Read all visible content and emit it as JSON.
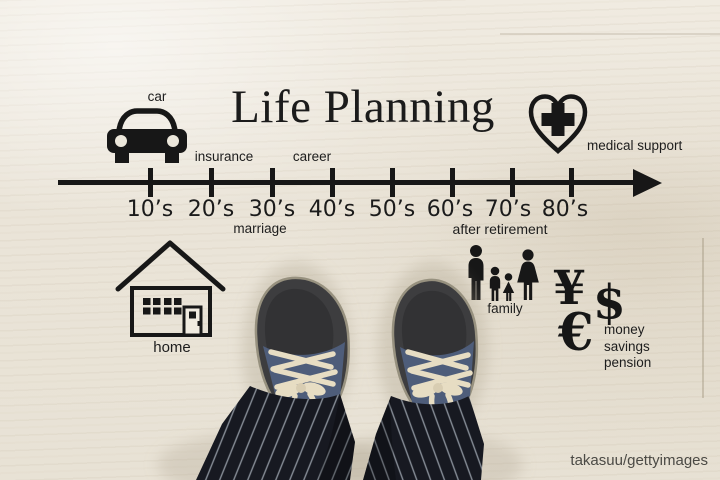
{
  "title": "Life Planning",
  "watermark": "takasuu/gettyimages",
  "timeline": {
    "decades": [
      "10’s",
      "20’s",
      "30’s",
      "40’s",
      "50’s",
      "60’s",
      "70’s",
      "80’s"
    ],
    "above_labels": [
      {
        "text": "insurance",
        "position": "above 20's"
      },
      {
        "text": "career",
        "position": "above 30's–40's"
      }
    ],
    "below_labels": [
      {
        "text": "marriage",
        "position": "below 30's"
      },
      {
        "text": "after retirement",
        "position": "below 60's–70's"
      }
    ]
  },
  "groups": {
    "car": {
      "label": "car",
      "icon": "car-icon"
    },
    "medical": {
      "label": "medical support",
      "icon": "heart-with-cross-icon"
    },
    "home": {
      "label": "home",
      "icon": "house-icon"
    },
    "family": {
      "label": "family",
      "icon": "family-silhouettes-icon"
    },
    "money": {
      "symbols": [
        "¥",
        "$",
        "€"
      ],
      "label_lines": [
        "money",
        "savings",
        "pension"
      ]
    }
  },
  "colors": {
    "ink": "#1a1a1a",
    "floor": "#eae4d8",
    "pants": "#171921",
    "pinstripe": "#9aa0aa",
    "shoe": "#3d3d3f",
    "shoe_denim": "#4e5d7a",
    "laces": "#e7ddc3",
    "watermark_text": "#4b4a45"
  }
}
